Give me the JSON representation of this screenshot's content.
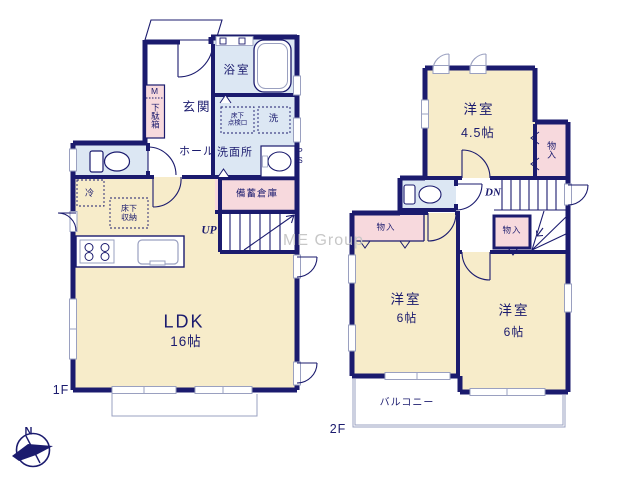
{
  "watermark": "ME Group",
  "compass": {
    "north": "N"
  },
  "colors": {
    "wall_navy": "#1b1b6e",
    "room_cream": "#f7ecca",
    "storage_pink": "#f7d9dd",
    "wet_area_blue": "#dce7f3",
    "fixture_gray": "#9aa0c0",
    "watermark_gray": "#c7c7c7"
  },
  "floor1": {
    "label": "1F",
    "entrance": "玄関",
    "shoe_cabinet_mark": "M",
    "shoe_cabinet": "下駄箱",
    "bathroom": "浴室",
    "washroom": "洗面所",
    "hall": "ホール",
    "washer": "洗",
    "underfloor_hatch": [
      "床下",
      "点検口"
    ],
    "pipe_space": "PS",
    "refrigerator": "冷",
    "underfloor_storage": [
      "床下",
      "収納"
    ],
    "stock_storage": "備蓄倉庫",
    "stairs": "UP",
    "ldk": "LDK",
    "ldk_size": "16帖"
  },
  "floor2": {
    "label": "2F",
    "room_45": "洋室",
    "room_45_size": "4.5帖",
    "closet_top_right": "物入",
    "closet_stairs": "物入",
    "closet_left": "物入",
    "stairs": "DN",
    "room_6_left": "洋室",
    "room_6_left_size": "6帖",
    "room_6_right": "洋室",
    "room_6_right_size": "6帖",
    "balcony": "バルコニー"
  }
}
